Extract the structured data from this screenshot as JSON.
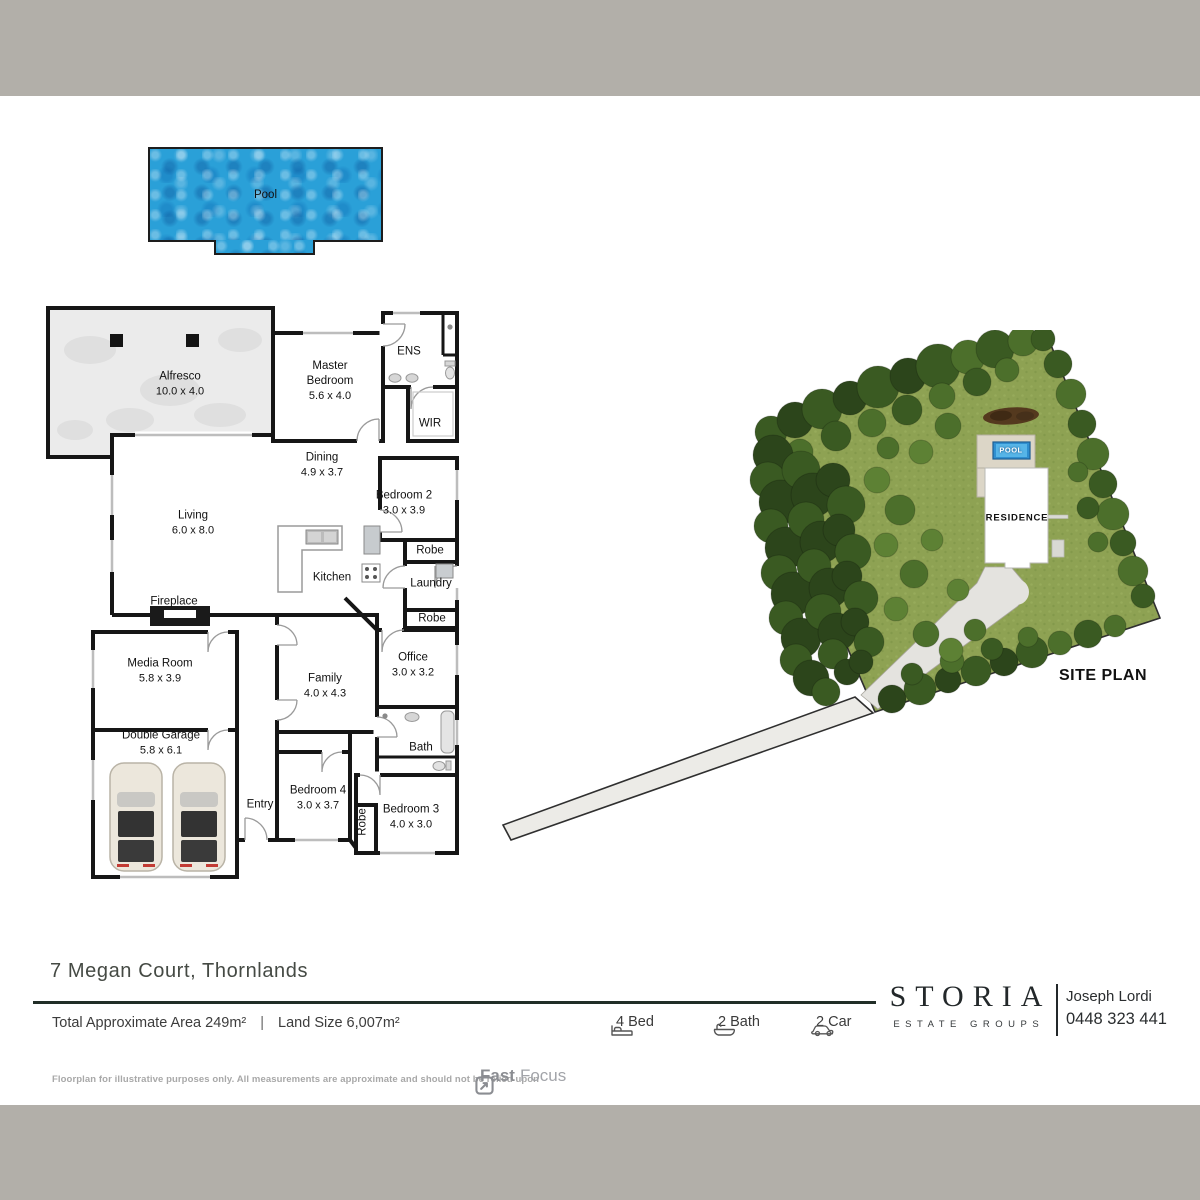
{
  "pool_plan": {
    "label": "Pool"
  },
  "floorplan": {
    "rooms": [
      {
        "name": "Alfresco",
        "dims": "10.0 x 4.0"
      },
      {
        "name": "Master Bedroom",
        "dims": "5.6 x 4.0"
      },
      {
        "name": "ENS"
      },
      {
        "name": "WIR"
      },
      {
        "name": "Dining",
        "dims": "4.9 x 3.7"
      },
      {
        "name": "Bedroom 2",
        "dims": "3.0 x 3.9"
      },
      {
        "name": "Living",
        "dims": "6.0 x 8.0"
      },
      {
        "name": "Kitchen"
      },
      {
        "name": "Robe"
      },
      {
        "name": "Laundry"
      },
      {
        "name": "Robe"
      },
      {
        "name": "Fireplace"
      },
      {
        "name": "Media Room",
        "dims": "5.8 x 3.9"
      },
      {
        "name": "Family",
        "dims": "4.0 x 4.3"
      },
      {
        "name": "Office",
        "dims": "3.0 x 3.2"
      },
      {
        "name": "Bath"
      },
      {
        "name": "Double Garage",
        "dims": "5.8 x 6.1"
      },
      {
        "name": "Entry"
      },
      {
        "name": "Bedroom 4",
        "dims": "3.0 x 3.7"
      },
      {
        "name": "Robe"
      },
      {
        "name": "Bedroom 3",
        "dims": "4.0 x 3.0"
      }
    ]
  },
  "siteplan": {
    "pool_label": "POOL",
    "residence_label": "RESIDENCE",
    "caption": "SITE PLAN"
  },
  "footer": {
    "address": "7 Megan Court, Thornlands",
    "total_area": "Total Approximate Area 249m²",
    "separator": "|",
    "land_size": "Land Size 6,007m²",
    "features": {
      "beds": "4 Bed",
      "baths": "2 Bath",
      "cars": "2 Car"
    },
    "brand": {
      "name": "STORIA",
      "tagline": "ESTATE GROUPS"
    },
    "agent": {
      "name": "Joseph Lordi",
      "phone": "0448 323 441"
    },
    "disclaimer": "Floorplan for illustrative purposes only. All measurements are approximate and should not be relied upon",
    "credit": {
      "bold": "Fast",
      "light": "Focus"
    }
  },
  "colors": {
    "band": "#b2afa9",
    "pool_water": "#2aa0d8",
    "grass": "#8ea253",
    "tree_dark": "#2f481c",
    "accent_line": "#212e27"
  }
}
